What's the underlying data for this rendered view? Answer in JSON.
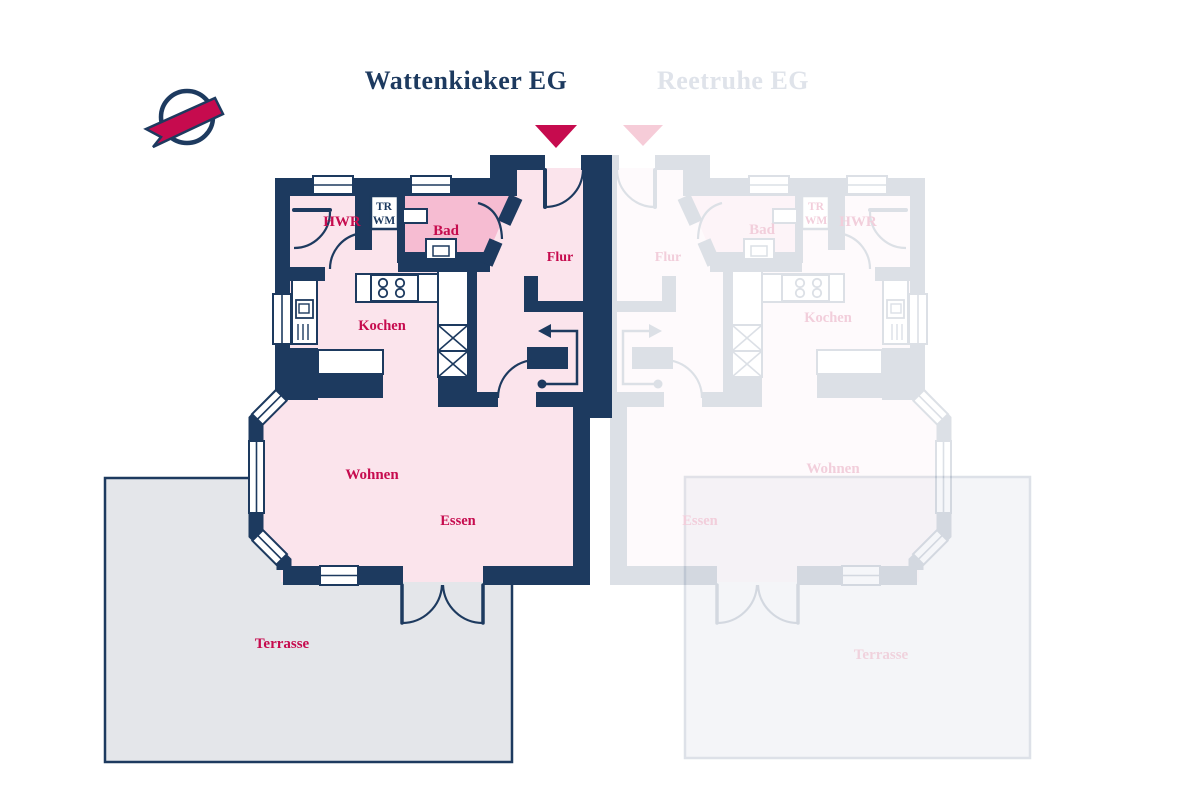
{
  "canvas": {
    "width": 1200,
    "height": 800,
    "background": "#ffffff"
  },
  "header": {
    "title_left": "Wattenkieker EG",
    "title_right": "Reetruhe EG"
  },
  "colors": {
    "navy": "#1d3a5f",
    "crimson": "#c60b4e",
    "room_pink": "#fbe4ec",
    "bad_pink": "#f6bcd2",
    "white": "#ffffff",
    "ghost_label": "#f2cedb",
    "ghost_title": "#dfe3ea",
    "ghost_triangle": "#f6ccd8",
    "ghost_opacity": 0.15
  },
  "logo": {
    "circle": {
      "cx": 187,
      "cy": 117,
      "r": 26,
      "stroke_width": 4.5
    },
    "ribbon_points": "146,129 215,98 223,114 153,147 161,137"
  },
  "markers": {
    "left_points": "535,125 577,125 556,148",
    "right_points": "623,125 663,125 643,146"
  },
  "terraces": {
    "left": {
      "x": 105,
      "y": 478,
      "w": 407,
      "h": 284,
      "fill": "#e4e6ea",
      "stroke": "#1d3a5f",
      "label": "Terrasse",
      "lx": 282,
      "ly": 648,
      "label_fill": "#c60b4e"
    },
    "right": {
      "x": 685,
      "y": 477,
      "w": 345,
      "h": 281,
      "fill": "#f4f5f8",
      "stroke": "#dde1e8",
      "label": "Terrasse",
      "lx": 881,
      "ly": 659,
      "label_fill": "#f0d2dd"
    }
  },
  "ghost": {
    "transform": "translate(1200,0) scale(-1,1)"
  },
  "floors": [
    {
      "n": "floor-hwr-hall",
      "t": "rect",
      "x": 290,
      "y": 192,
      "w": 113,
      "h": 84,
      "fill": "room_pink"
    },
    {
      "n": "floor-kochen",
      "t": "rect",
      "x": 290,
      "y": 265,
      "w": 175,
      "h": 133,
      "fill": "room_pink"
    },
    {
      "n": "floor-flur",
      "t": "poly",
      "points": "465,192 513,192 513,168 583,168 583,396 477,396 477,261 465,261",
      "fill": "room_pink"
    },
    {
      "n": "floor-wohnen-essen",
      "t": "poly",
      "points": "281,394 253,421 253,535 281,562 281,582 580,582 580,394",
      "fill": "room_pink"
    },
    {
      "n": "floor-bad",
      "t": "poly",
      "points": "398,196 513,196 484,263 398,263",
      "fill": "bad_pink"
    }
  ],
  "walls": [
    {
      "n": "wall-top",
      "t": "rect",
      "x": 275,
      "y": 178,
      "w": 242,
      "h": 18
    },
    {
      "n": "wall-entry-step",
      "t": "rect",
      "x": 490,
      "y": 155,
      "w": 27,
      "h": 41
    },
    {
      "n": "wall-flur-top-left",
      "t": "rect",
      "x": 513,
      "y": 155,
      "w": 32,
      "h": 15
    },
    {
      "n": "wall-flur-top-right",
      "t": "rect",
      "x": 581,
      "y": 155,
      "w": 31,
      "h": 15
    },
    {
      "n": "wall-party",
      "t": "rect",
      "x": 583,
      "y": 155,
      "w": 29,
      "h": 251
    },
    {
      "n": "wall-rear-step",
      "t": "rect",
      "x": 573,
      "y": 400,
      "w": 39,
      "h": 18
    },
    {
      "n": "wall-left",
      "t": "rect",
      "x": 275,
      "y": 178,
      "w": 15,
      "h": 222
    },
    {
      "n": "wall-bottom-left",
      "t": "rect",
      "x": 283,
      "y": 566,
      "w": 120,
      "h": 19
    },
    {
      "n": "wall-bottom-right",
      "t": "rect",
      "x": 483,
      "y": 566,
      "w": 107,
      "h": 19
    },
    {
      "n": "wall-right-lower",
      "t": "rect",
      "x": 573,
      "y": 410,
      "w": 17,
      "h": 175
    },
    {
      "n": "wall-hwr-divider",
      "t": "rect",
      "x": 355,
      "y": 192,
      "w": 17,
      "h": 58
    },
    {
      "n": "wall-trwm-bad",
      "t": "rect",
      "x": 397,
      "y": 196,
      "w": 8,
      "h": 67
    },
    {
      "n": "wall-hwr-bottom",
      "t": "rect",
      "x": 290,
      "y": 267,
      "w": 35,
      "h": 14
    },
    {
      "n": "wall-bad-bottom",
      "t": "rect",
      "x": 398,
      "y": 252,
      "w": 92,
      "h": 20
    },
    {
      "n": "wall-bad-diag-upper",
      "t": "line",
      "x1": 516,
      "y1": 197,
      "x2": 504,
      "y2": 223,
      "w": 14
    },
    {
      "n": "wall-bad-diag-lower",
      "t": "line",
      "x1": 496,
      "y1": 241,
      "x2": 486,
      "y2": 264,
      "w": 14
    },
    {
      "n": "wall-flur-bottom-left",
      "t": "rect",
      "x": 465,
      "y": 392,
      "w": 33,
      "h": 15
    },
    {
      "n": "wall-flur-bottom-right",
      "t": "rect",
      "x": 536,
      "y": 392,
      "w": 76,
      "h": 15
    },
    {
      "n": "wall-units-stub",
      "t": "rect",
      "x": 438,
      "y": 375,
      "w": 30,
      "h": 32
    },
    {
      "n": "wall-kitchen-flur",
      "t": "rect",
      "x": 465,
      "y": 263,
      "w": 12,
      "h": 129
    },
    {
      "n": "wall-stair-v",
      "t": "rect",
      "x": 524,
      "y": 276,
      "w": 14,
      "h": 36
    },
    {
      "n": "wall-stair-h",
      "t": "rect",
      "x": 524,
      "y": 301,
      "w": 59,
      "h": 11
    },
    {
      "n": "wall-corner-block",
      "t": "rect",
      "x": 275,
      "y": 348,
      "w": 43,
      "h": 52
    },
    {
      "n": "wall-kochen-wohnen",
      "t": "rect",
      "x": 318,
      "y": 374,
      "w": 65,
      "h": 24
    },
    {
      "n": "stair-block",
      "t": "rect",
      "x": 527,
      "y": 347,
      "w": 41,
      "h": 22
    },
    {
      "n": "wall-bay",
      "t": "path",
      "d": "M 282,393 L 256,420 L 256,534 L 284,562 L 284,570",
      "w": 15
    }
  ],
  "windows": [
    {
      "n": "window-top-hwr",
      "x": 313,
      "y": 176,
      "w": 40,
      "h": 18,
      "line": "h"
    },
    {
      "n": "window-top-bad",
      "x": 411,
      "y": 176,
      "w": 40,
      "h": 18,
      "line": "h"
    },
    {
      "n": "window-kitchen-left",
      "x": 273,
      "y": 294,
      "w": 18,
      "h": 50,
      "line": "v"
    },
    {
      "n": "window-bay-upper",
      "x": 252,
      "y": 400,
      "w": 34,
      "h": 15,
      "line": "h",
      "rot": "-45 269 407"
    },
    {
      "n": "window-bay-left",
      "x": 249,
      "y": 441,
      "w": 15,
      "h": 72,
      "line": "v"
    },
    {
      "n": "window-bay-lower",
      "x": 253,
      "y": 540,
      "w": 34,
      "h": 15,
      "line": "h",
      "rot": "45 270 547"
    },
    {
      "n": "window-bottom",
      "x": 320,
      "y": 566,
      "w": 38,
      "h": 19,
      "line": "h"
    }
  ],
  "fixtures": [
    {
      "n": "appliance-trwm-box",
      "t": "rect",
      "x": 371,
      "y": 196,
      "w": 27,
      "h": 33,
      "sw": 2.5
    },
    {
      "n": "kitchen-counter-top",
      "t": "rect",
      "x": 356,
      "y": 274,
      "w": 82,
      "h": 28,
      "sw": 2
    },
    {
      "n": "stove",
      "t": "rect",
      "x": 371,
      "y": 275,
      "w": 47,
      "h": 26,
      "sw": 2
    },
    {
      "n": "stove-burner-1",
      "t": "circle",
      "cx": 383,
      "cy": 283,
      "r": 4.2,
      "sw": 1.8
    },
    {
      "n": "stove-burner-2",
      "t": "circle",
      "cx": 400,
      "cy": 283,
      "r": 4.2,
      "sw": 1.8
    },
    {
      "n": "stove-burner-3",
      "t": "circle",
      "cx": 383,
      "cy": 293,
      "r": 4.2,
      "sw": 1.8
    },
    {
      "n": "stove-burner-4",
      "t": "circle",
      "cx": 400,
      "cy": 293,
      "r": 4.2,
      "sw": 1.8
    },
    {
      "n": "kitchen-tall-cabinet",
      "t": "rect",
      "x": 438,
      "y": 271,
      "w": 30,
      "h": 54,
      "sw": 2
    },
    {
      "n": "kitchen-appliance-x1",
      "t": "xrect",
      "x": 438,
      "y": 325,
      "w": 30,
      "h": 26,
      "sw": 2
    },
    {
      "n": "kitchen-appliance-x2",
      "t": "xrect",
      "x": 438,
      "y": 351,
      "w": 30,
      "h": 26,
      "sw": 2
    },
    {
      "n": "sink-counter",
      "t": "rect",
      "x": 292,
      "y": 280,
      "w": 25,
      "h": 64,
      "sw": 2
    },
    {
      "n": "sink",
      "t": "rect",
      "x": 296,
      "y": 300,
      "w": 17,
      "h": 18,
      "sw": 1.8
    },
    {
      "n": "sink-basin",
      "t": "rect",
      "x": 299,
      "y": 304,
      "w": 10,
      "h": 9,
      "sw": 1.4
    },
    {
      "n": "sink-hatch-1",
      "t": "line",
      "x1": 298,
      "y1": 324,
      "x2": 298,
      "y2": 340,
      "sw": 1.4
    },
    {
      "n": "sink-hatch-2",
      "t": "line",
      "x1": 303,
      "y1": 324,
      "x2": 303,
      "y2": 340,
      "sw": 1.4
    },
    {
      "n": "sink-hatch-3",
      "t": "line",
      "x1": 308,
      "y1": 324,
      "x2": 308,
      "y2": 340,
      "sw": 1.4
    },
    {
      "n": "kitchen-counter-bottom",
      "t": "rect",
      "x": 318,
      "y": 350,
      "w": 65,
      "h": 24,
      "sw": 2
    },
    {
      "n": "toilet",
      "t": "rect",
      "x": 426,
      "y": 239,
      "w": 30,
      "h": 20,
      "sw": 2
    },
    {
      "n": "toilet-bowl",
      "t": "rect",
      "x": 433,
      "y": 246,
      "w": 16,
      "h": 10,
      "sw": 1.5
    },
    {
      "n": "washbasin",
      "t": "rect",
      "x": 403,
      "y": 209,
      "w": 24,
      "h": 14,
      "sw": 2
    }
  ],
  "doors": [
    {
      "n": "door-hwr-leaf",
      "t": "line",
      "x1": 294,
      "y1": 210,
      "x2": 330,
      "y2": 210,
      "sw": 4
    },
    {
      "n": "door-hwr-arc",
      "t": "path",
      "d": "M 330,212 A 36 36 0 0 1 294,248",
      "sw": 2.2
    },
    {
      "n": "door-kochen-arc",
      "t": "path",
      "d": "M 357,234 A 36 36 0 0 0 330,269",
      "sw": 2.2
    },
    {
      "n": "door-bad-arc",
      "t": "path",
      "d": "M 478,203 Q 501,209 502,239",
      "sw": 2.2
    },
    {
      "n": "door-entry-leaf",
      "t": "line",
      "x1": 545,
      "y1": 170,
      "x2": 545,
      "y2": 207,
      "sw": 4
    },
    {
      "n": "door-entry-arc",
      "t": "path",
      "d": "M 545,207 A 38 38 0 0 0 583,170",
      "sw": 2.2
    },
    {
      "n": "door-stair-arc",
      "t": "path",
      "d": "M 498,398 A 38 38 0 0 1 536,360",
      "sw": 2.2
    },
    {
      "n": "door-terrace-leaf-left",
      "t": "line",
      "x1": 402,
      "y1": 585,
      "x2": 402,
      "y2": 623,
      "sw": 3.5
    },
    {
      "n": "door-terrace-leaf-right",
      "t": "line",
      "x1": 483,
      "y1": 585,
      "x2": 483,
      "y2": 623,
      "sw": 3.5
    },
    {
      "n": "door-terrace-arc-left",
      "t": "path",
      "d": "M 402,623 A 40 40 0 0 0 442,585",
      "sw": 2.2
    },
    {
      "n": "door-terrace-arc-right",
      "t": "path",
      "d": "M 483,623 A 40 40 0 0 1 443,585",
      "sw": 2.2
    }
  ],
  "stairs_arrow": {
    "dot": {
      "cx": 542,
      "cy": 384,
      "r": 4.5
    },
    "path": "M 542,384 L 577,384 L 577,331 L 551,331",
    "head_points": "551,324 538,331 551,338",
    "sw": 2.5
  },
  "rooms": {
    "left": [
      {
        "text": "HWR",
        "x": 342,
        "y": 226,
        "size": 15
      },
      {
        "text": "Bad",
        "x": 446,
        "y": 235,
        "size": 15
      },
      {
        "text": "Flur",
        "x": 560,
        "y": 261,
        "size": 14
      },
      {
        "text": "Kochen",
        "x": 382,
        "y": 330,
        "size": 14.5
      },
      {
        "text": "Wohnen",
        "x": 372,
        "y": 479,
        "size": 15
      },
      {
        "text": "Essen",
        "x": 458,
        "y": 525,
        "size": 14.5
      }
    ],
    "right": [
      {
        "text": "Flur",
        "x": 668,
        "y": 261,
        "size": 14
      },
      {
        "text": "Bad",
        "x": 762,
        "y": 234,
        "size": 15
      },
      {
        "text": "HWR",
        "x": 858,
        "y": 226,
        "size": 15
      },
      {
        "text": "Kochen",
        "x": 828,
        "y": 322,
        "size": 14.5
      },
      {
        "text": "Wohnen",
        "x": 833,
        "y": 473,
        "size": 15
      },
      {
        "text": "Essen",
        "x": 700,
        "y": 525,
        "size": 14.5
      }
    ]
  },
  "appliance_text": {
    "left": [
      {
        "text": "TR",
        "x": 384,
        "y": 210
      },
      {
        "text": "WM",
        "x": 384,
        "y": 224
      }
    ],
    "right": [
      {
        "text": "TR",
        "x": 816,
        "y": 210
      },
      {
        "text": "WM",
        "x": 816,
        "y": 224
      }
    ]
  }
}
